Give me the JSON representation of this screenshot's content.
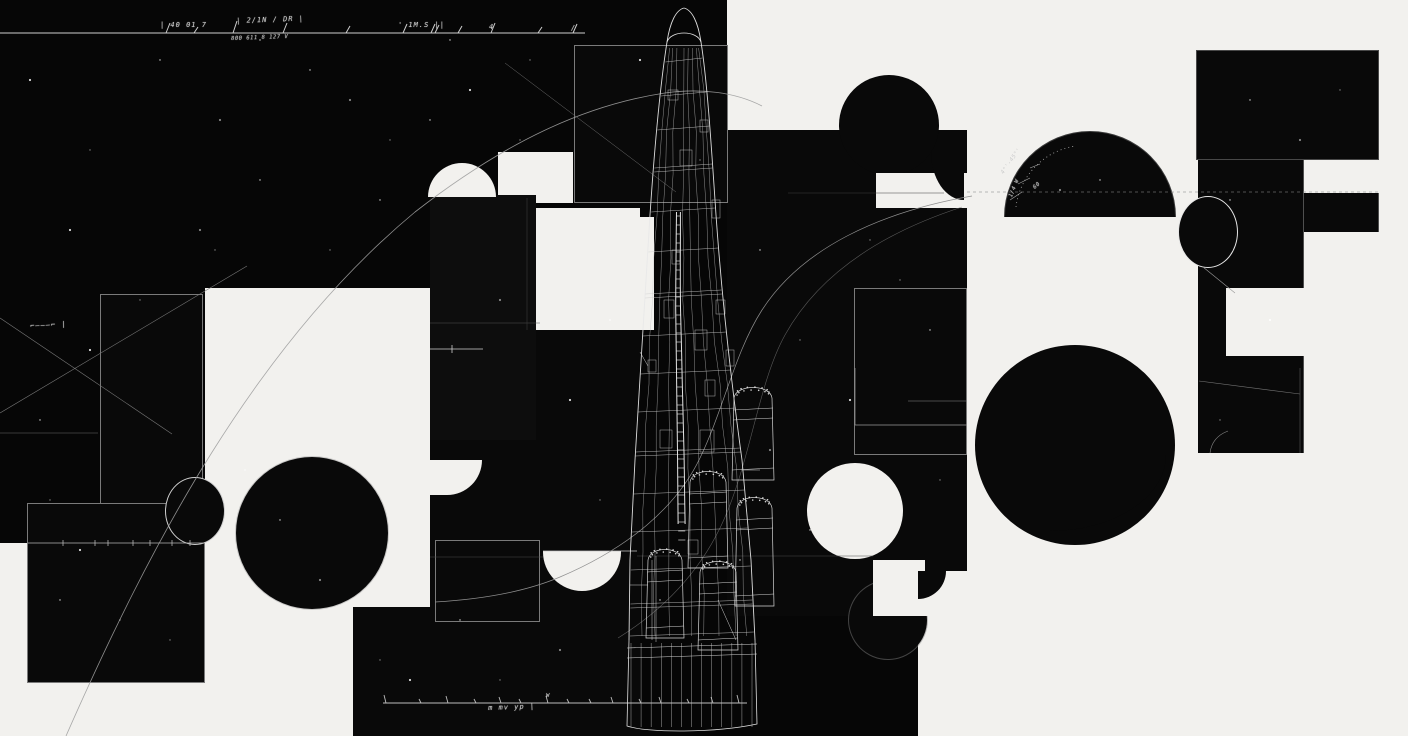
{
  "artwork": {
    "subject": "abstract black-and-white blueprint collage with wireframe rocket",
    "palette": {
      "paper": "#f2f1ee",
      "ink": "#090909",
      "wireframe_line": "#d8d8d8",
      "faint_line": "#8f8f8f",
      "scribble_text": "#c9c9c9"
    },
    "annotations": {
      "top_ruler": {
        "label_1": "| 40 01 7",
        "label_2": "| 2/1N / DR |",
        "sub_label": "800 611 8 127  V",
        "label_3": "' 1M.S  ||",
        "label_4": "4",
        "label_5": "/"
      },
      "left_note": "⌐———⌐ |",
      "bottom_ruler_note": "m   mv   yp   |",
      "bottom_ruler_mark": "W",
      "dome_note_1": "4°'-45°'",
      "dome_note_2": "1/4 W",
      "dome_note_3": "60"
    }
  }
}
